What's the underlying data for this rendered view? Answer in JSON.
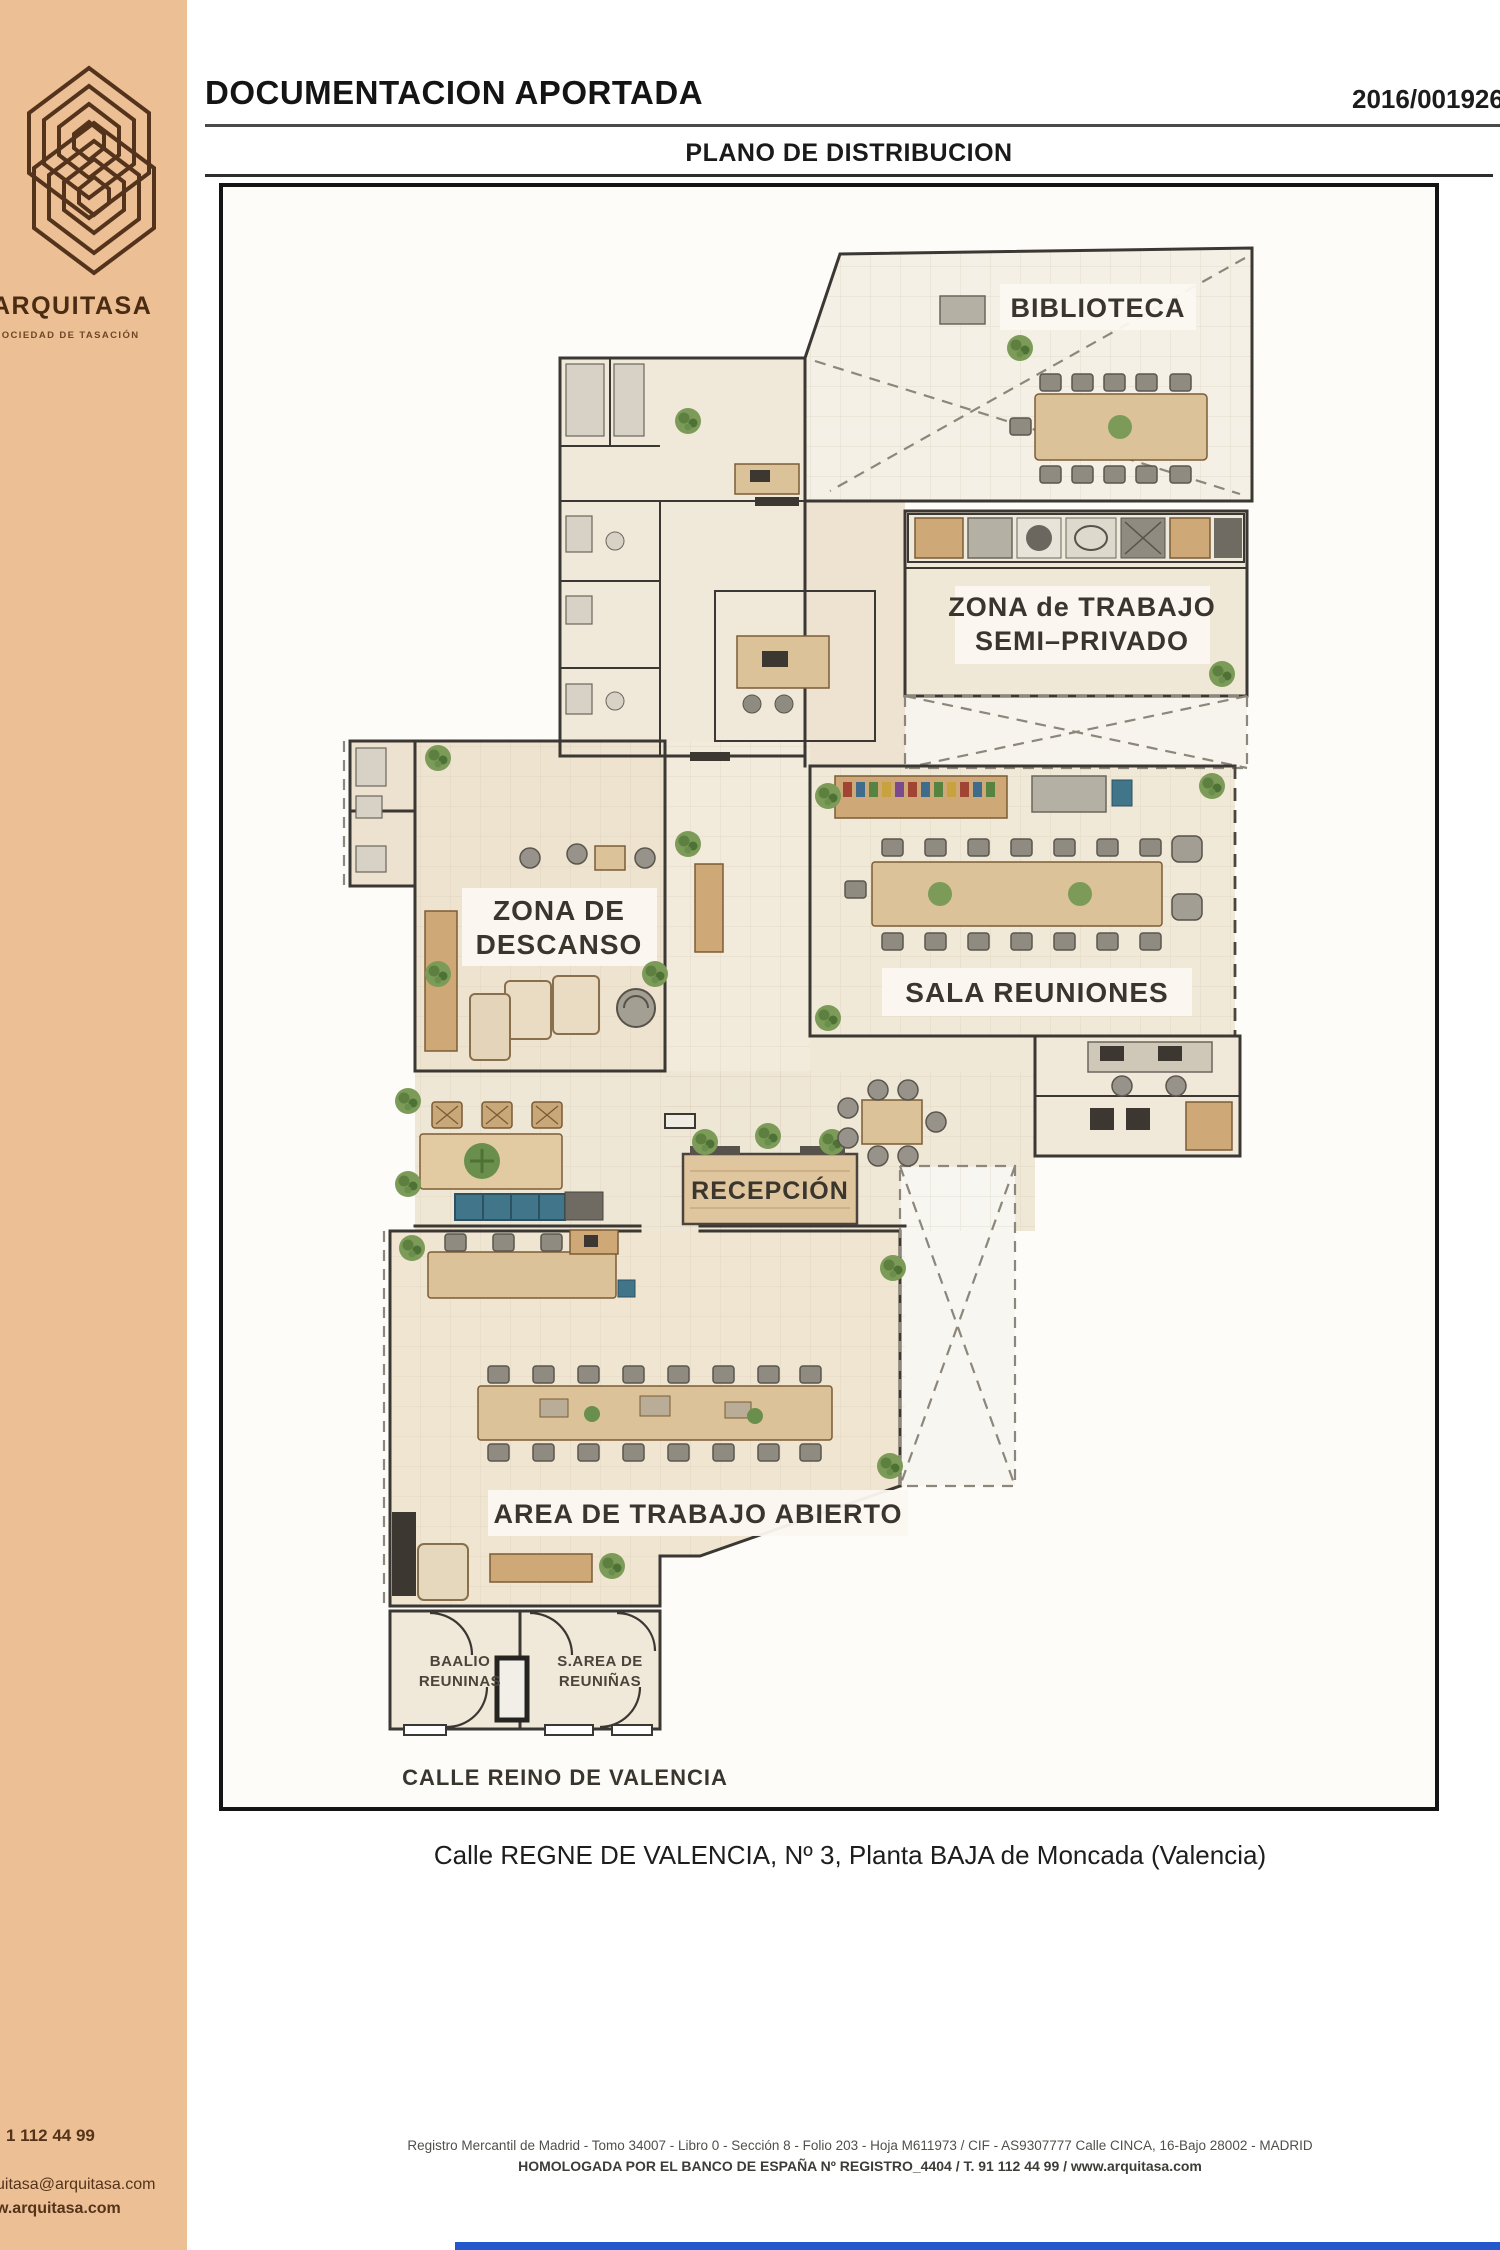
{
  "sidebar": {
    "brand": "ARQUITASA",
    "brand_sub": "SOCIEDAD DE TASACIÓN",
    "phone": "1 112 44 99",
    "email": "uitasa@arquitasa.com",
    "website": "w.arquitasa.com"
  },
  "header": {
    "title": "DOCUMENTACION APORTADA",
    "case_number": "2016/0019260",
    "subtitle": "PLANO DE DISTRIBUCION"
  },
  "plan": {
    "rooms": {
      "biblioteca": "BIBLIOTECA",
      "zona_trabajo_line1": "ZONA de TRABAJO",
      "zona_trabajo_line2": "SEMI–PRIVADO",
      "zona_descanso_line1": "ZONA DE",
      "zona_descanso_line2": "DESCANSO",
      "sala_reuniones": "SALA REUNIONES",
      "recepcion": "RECEPCIÓN",
      "area_trabajo": "AREA DE TRABAJO ABIERTO",
      "sala_b_izq_line1": "BAALIO",
      "sala_b_izq_line2": "REUNINAS",
      "sala_b_der_line1": "S.AREA DE",
      "sala_b_der_line2": "REUNIÑAS"
    },
    "street": "CALLE REINO DE VALENCIA"
  },
  "caption": "Calle REGNE DE VALENCIA, Nº 3, Planta BAJA de Moncada (Valencia)",
  "footer": {
    "line1": "Registro Mercantil de Madrid - Tomo 34007 - Libro 0 - Sección 8 - Folio 203 - Hoja M611973 / CIF - AS9307777 Calle CINCA, 16-Bajo 28002 - MADRID",
    "line2": "HOMOLOGADA POR EL BANCO DE ESPAÑA Nº REGISTRO_4404 / T. 91 112 44 99 / www.arquitasa.com"
  },
  "colors": {
    "sidebar": "#edbf95",
    "brand_text": "#4a2c12",
    "wall": "#3b3733",
    "wood": "#dcc298",
    "teal": "#40758a",
    "plant": "#7c9b58",
    "floor": "#efe7d5",
    "footer_bar": "#2457cc"
  }
}
